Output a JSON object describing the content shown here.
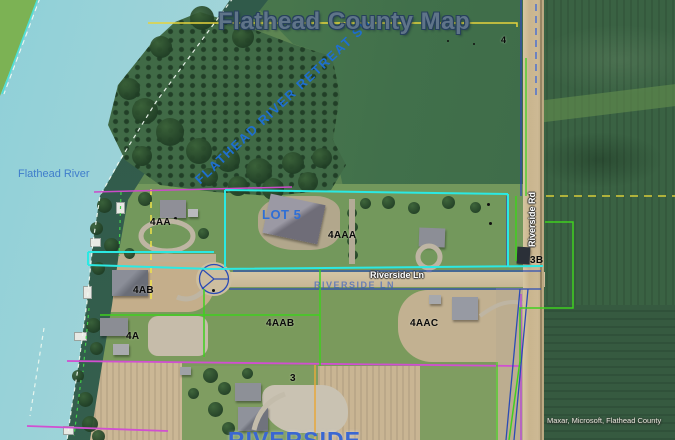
{
  "map": {
    "title": "Flathead County Map",
    "labels": {
      "subdivision_diagonal": "FLATHEAD RIVER RETREAT SU",
      "river": "Flathead River",
      "subdivision_bottom": "RIVERSIDE"
    },
    "roads": {
      "riverside_ln": "Riverside Ln",
      "riverside_ln_overlay": "RIVERSIDE LN",
      "riverside_rd": "Riverside Rd"
    },
    "parcels": {
      "p4": "4",
      "p4aa": "4AA",
      "lot5": "LOT 5",
      "p4aaa": "4AAA",
      "p4ab": "4AB",
      "p4a": "4A",
      "p4aab": "4AAB",
      "p4aac": "4AAC",
      "p3b": "3B",
      "p3": "3"
    },
    "attribution": "Maxar, Microsoft, Flathead County",
    "colors": {
      "water": "#a7d5d9",
      "boundary_cyan": "#2be9e3",
      "boundary_magenta": "#cc4ccc",
      "boundary_yellow": "#e6d33c",
      "boundary_orange": "#e7a83b",
      "boundary_green": "#3fd01f",
      "boundary_navy": "#2b4bb5",
      "label_blue": "#2f6fd6",
      "title_fill": "#5f7489"
    }
  }
}
